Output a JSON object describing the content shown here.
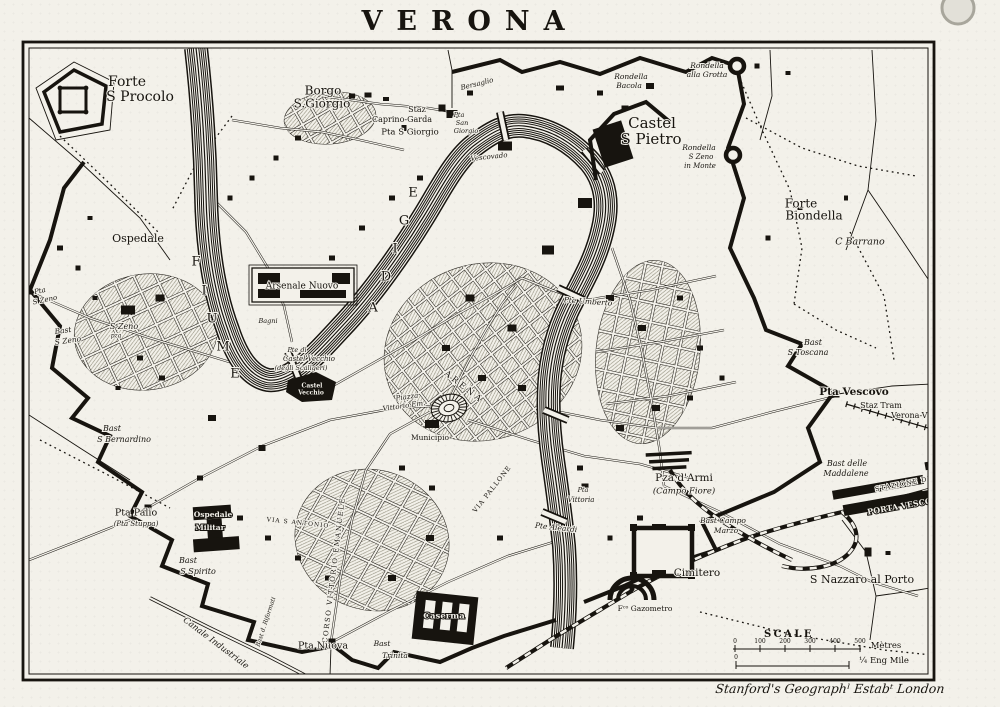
{
  "title": "VERONA",
  "credit": "Stanford's Geographˡ Estabᵗ London",
  "colors": {
    "paper": "#f3f1ea",
    "ink": "#17140f"
  },
  "scale": {
    "heading": "SCALE",
    "metres": [
      "0",
      "100",
      "200",
      "300",
      "400",
      "500"
    ],
    "metres_unit": "Mètres",
    "mile_zero": "0",
    "mile_unit": "¼ Eng Mile"
  },
  "labels": [
    {
      "t": "Forte",
      "x": 127,
      "y": 82,
      "s": 14
    },
    {
      "t": "S Procolo",
      "x": 140,
      "y": 97,
      "s": 14
    },
    {
      "t": "Borgo",
      "x": 323,
      "y": 91,
      "s": 12
    },
    {
      "t": "S.Giorgio",
      "x": 322,
      "y": 104,
      "s": 12
    },
    {
      "t": "Staz",
      "x": 417,
      "y": 110,
      "s": 8
    },
    {
      "t": "Caprino-Garda",
      "x": 402,
      "y": 120,
      "s": 8
    },
    {
      "t": "Pta S Giorgio",
      "x": 410,
      "y": 132,
      "s": 8.5
    },
    {
      "t": "Pta",
      "x": 459,
      "y": 115,
      "s": 6.5,
      "st": "i"
    },
    {
      "t": "San",
      "x": 462,
      "y": 123,
      "s": 6.5,
      "st": "i"
    },
    {
      "t": "Giorgio",
      "x": 466,
      "y": 131,
      "s": 6.5,
      "st": "i"
    },
    {
      "t": "Bersaglio",
      "x": 477,
      "y": 84,
      "s": 7,
      "st": "i",
      "r": -14
    },
    {
      "t": "Rondella",
      "x": 631,
      "y": 77,
      "s": 7.5,
      "st": "i"
    },
    {
      "t": "Bacola",
      "x": 629,
      "y": 86,
      "s": 7.5,
      "st": "i"
    },
    {
      "t": "Rondella",
      "x": 707,
      "y": 66,
      "s": 7.5,
      "st": "i"
    },
    {
      "t": "alla Grotta",
      "x": 707,
      "y": 75,
      "s": 7.5,
      "st": "i"
    },
    {
      "t": "Castel",
      "x": 652,
      "y": 124,
      "s": 15
    },
    {
      "t": "S Pietro",
      "x": 651,
      "y": 140,
      "s": 15
    },
    {
      "t": "Rondella",
      "x": 699,
      "y": 148,
      "s": 7.5,
      "st": "i"
    },
    {
      "t": "S Zeno",
      "x": 701,
      "y": 157,
      "s": 7,
      "st": "i"
    },
    {
      "t": "in Monte",
      "x": 700,
      "y": 166,
      "s": 7,
      "st": "i"
    },
    {
      "t": "Forte",
      "x": 801,
      "y": 204,
      "s": 12
    },
    {
      "t": "Biondella",
      "x": 814,
      "y": 216,
      "s": 12
    },
    {
      "t": "C Barrano",
      "x": 860,
      "y": 242,
      "s": 9.5,
      "st": "i"
    },
    {
      "t": "Vescovado",
      "x": 489,
      "y": 157,
      "s": 7,
      "st": "i",
      "r": -6
    },
    {
      "t": "Ospedale",
      "x": 138,
      "y": 239,
      "s": 11
    },
    {
      "t": "Pta",
      "x": 40,
      "y": 291,
      "s": 7,
      "st": "i",
      "r": -12
    },
    {
      "t": "S Zeno",
      "x": 45,
      "y": 300,
      "s": 7,
      "st": "i",
      "r": -12
    },
    {
      "t": "Bast",
      "x": 63,
      "y": 331,
      "s": 7.5,
      "st": "i",
      "r": -8
    },
    {
      "t": "S Zeno",
      "x": 68,
      "y": 341,
      "s": 7.5,
      "st": "i",
      "r": -8
    },
    {
      "t": "S Zeno",
      "x": 124,
      "y": 327,
      "s": 8,
      "st": "i"
    },
    {
      "t": "pza",
      "x": 116,
      "y": 336,
      "s": 6,
      "st": "i"
    },
    {
      "t": "Bast",
      "x": 112,
      "y": 429,
      "s": 8,
      "st": "i"
    },
    {
      "t": "S Bernardino",
      "x": 124,
      "y": 440,
      "s": 8,
      "st": "i"
    },
    {
      "t": "F",
      "x": 197,
      "y": 262,
      "s": 13,
      "st": "c"
    },
    {
      "t": "I",
      "x": 205,
      "y": 291,
      "s": 13,
      "st": "c"
    },
    {
      "t": "U",
      "x": 213,
      "y": 319,
      "s": 13,
      "st": "c"
    },
    {
      "t": "M",
      "x": 224,
      "y": 347,
      "s": 13,
      "st": "c"
    },
    {
      "t": "E",
      "x": 236,
      "y": 374,
      "s": 13,
      "st": "c"
    },
    {
      "t": "A",
      "x": 374,
      "y": 308,
      "s": 13,
      "st": "c"
    },
    {
      "t": "D",
      "x": 387,
      "y": 277,
      "s": 13,
      "st": "c"
    },
    {
      "t": "I",
      "x": 396,
      "y": 249,
      "s": 13,
      "st": "c"
    },
    {
      "t": "G",
      "x": 405,
      "y": 221,
      "s": 13,
      "st": "c"
    },
    {
      "t": "E",
      "x": 414,
      "y": 193,
      "s": 13,
      "st": "c"
    },
    {
      "t": "Arsenale Nuovo",
      "x": 302,
      "y": 286,
      "s": 9
    },
    {
      "t": "Bagni",
      "x": 268,
      "y": 321,
      "s": 6.5,
      "st": "i"
    },
    {
      "t": "Pte di",
      "x": 297,
      "y": 350,
      "s": 6.5,
      "st": "i"
    },
    {
      "t": "Castel Vecchio",
      "x": 309,
      "y": 359,
      "s": 7,
      "st": "i"
    },
    {
      "t": "(degli Scaligeri)",
      "x": 301,
      "y": 368,
      "s": 6.5,
      "st": "i"
    },
    {
      "t": "Castel",
      "x": 312,
      "y": 386,
      "s": 6,
      "st": "w"
    },
    {
      "t": "Vecchio",
      "x": 311,
      "y": 393,
      "s": 6,
      "st": "w"
    },
    {
      "t": "ARENA",
      "x": 464,
      "y": 387,
      "s": 8.5,
      "st": "c",
      "r": 38,
      "sp": 3
    },
    {
      "t": "Piazza",
      "x": 407,
      "y": 397,
      "s": 7,
      "st": "i",
      "r": -8
    },
    {
      "t": "Vittorio Em.",
      "x": 404,
      "y": 406,
      "s": 7,
      "st": "i",
      "r": -8
    },
    {
      "t": "Municipio",
      "x": 430,
      "y": 438,
      "s": 7.5
    },
    {
      "t": "Pte Umberto",
      "x": 588,
      "y": 302,
      "s": 7.5,
      "st": "i",
      "r": 4
    },
    {
      "t": "CORSO VITTORIO EMANUELE",
      "x": 334,
      "y": 570,
      "s": 7,
      "st": "c",
      "r": -83,
      "sp": 1.5
    },
    {
      "t": "VIA PALLONE",
      "x": 492,
      "y": 489,
      "s": 6.5,
      "st": "c",
      "r": -52,
      "sp": 1
    },
    {
      "t": "VIA S ANTONIO",
      "x": 298,
      "y": 523,
      "s": 6,
      "st": "c",
      "r": 6,
      "sp": 1
    },
    {
      "t": "Bast",
      "x": 813,
      "y": 343,
      "s": 8,
      "st": "i"
    },
    {
      "t": "S Toscana",
      "x": 808,
      "y": 353,
      "s": 8,
      "st": "i"
    },
    {
      "t": "Pta Vescovo",
      "x": 854,
      "y": 392,
      "s": 10.5,
      "st": "b"
    },
    {
      "t": "Staz Tram",
      "x": 881,
      "y": 406,
      "s": 8
    },
    {
      "t": "Verona-Vicenz.",
      "x": 921,
      "y": 416,
      "s": 8
    },
    {
      "t": "Bast delle",
      "x": 847,
      "y": 464,
      "s": 8,
      "st": "i"
    },
    {
      "t": "Maddalene",
      "x": 846,
      "y": 474,
      "s": 8,
      "st": "i"
    },
    {
      "t": "Pza d'Armi",
      "x": 684,
      "y": 478,
      "s": 10.5
    },
    {
      "t": "(Campo Fiore)",
      "x": 684,
      "y": 491,
      "s": 8.5,
      "st": "i"
    },
    {
      "t": "Bast Campo",
      "x": 723,
      "y": 521,
      "s": 7.5,
      "st": "i"
    },
    {
      "t": "Marzo",
      "x": 726,
      "y": 531,
      "s": 7.5,
      "st": "i"
    },
    {
      "t": "STAZIONE DI",
      "x": 903,
      "y": 484,
      "s": 6.5,
      "st": "c",
      "r": -11,
      "sp": 1
    },
    {
      "t": "PORTA VESCOVO",
      "x": 906,
      "y": 506,
      "s": 8,
      "st": "w",
      "r": -10,
      "sp": 1
    },
    {
      "t": "S Nazzaro al Porto",
      "x": 862,
      "y": 580,
      "s": 11
    },
    {
      "t": "Cimitero",
      "x": 697,
      "y": 573,
      "s": 10.5
    },
    {
      "t": "Fᶜᵒ Gazometro",
      "x": 645,
      "y": 609,
      "s": 7.5
    },
    {
      "t": "Caserma",
      "x": 444,
      "y": 616,
      "s": 8.5,
      "st": "w"
    },
    {
      "t": "Pta Nuova",
      "x": 323,
      "y": 646,
      "s": 9.5
    },
    {
      "t": "Bast",
      "x": 382,
      "y": 644,
      "s": 7.5,
      "st": "i"
    },
    {
      "t": "Trinita",
      "x": 395,
      "y": 656,
      "s": 7.5,
      "st": "i"
    },
    {
      "t": "Bast d. Riformati",
      "x": 266,
      "y": 622,
      "s": 6,
      "st": "i",
      "r": -72
    },
    {
      "t": "Pta Palio",
      "x": 136,
      "y": 513,
      "s": 9.5
    },
    {
      "t": "(Pta Stuppa)",
      "x": 136,
      "y": 524,
      "s": 7,
      "st": "i"
    },
    {
      "t": "Ospedale",
      "x": 213,
      "y": 515,
      "s": 7.5,
      "st": "w"
    },
    {
      "t": "Militar",
      "x": 210,
      "y": 528,
      "s": 7.5,
      "st": "w"
    },
    {
      "t": "Bast",
      "x": 188,
      "y": 561,
      "s": 8,
      "st": "i"
    },
    {
      "t": "S Spirito",
      "x": 198,
      "y": 572,
      "s": 8,
      "st": "i"
    },
    {
      "t": "Canale Industriale",
      "x": 216,
      "y": 643,
      "s": 8.5,
      "st": "i",
      "r": 37
    },
    {
      "t": "Pte Aleardi",
      "x": 556,
      "y": 528,
      "s": 7.5,
      "st": "i",
      "r": 6
    },
    {
      "t": "Pta",
      "x": 583,
      "y": 490,
      "s": 6.5,
      "st": "i"
    },
    {
      "t": "Vittoria",
      "x": 581,
      "y": 500,
      "s": 7,
      "st": "i"
    }
  ]
}
